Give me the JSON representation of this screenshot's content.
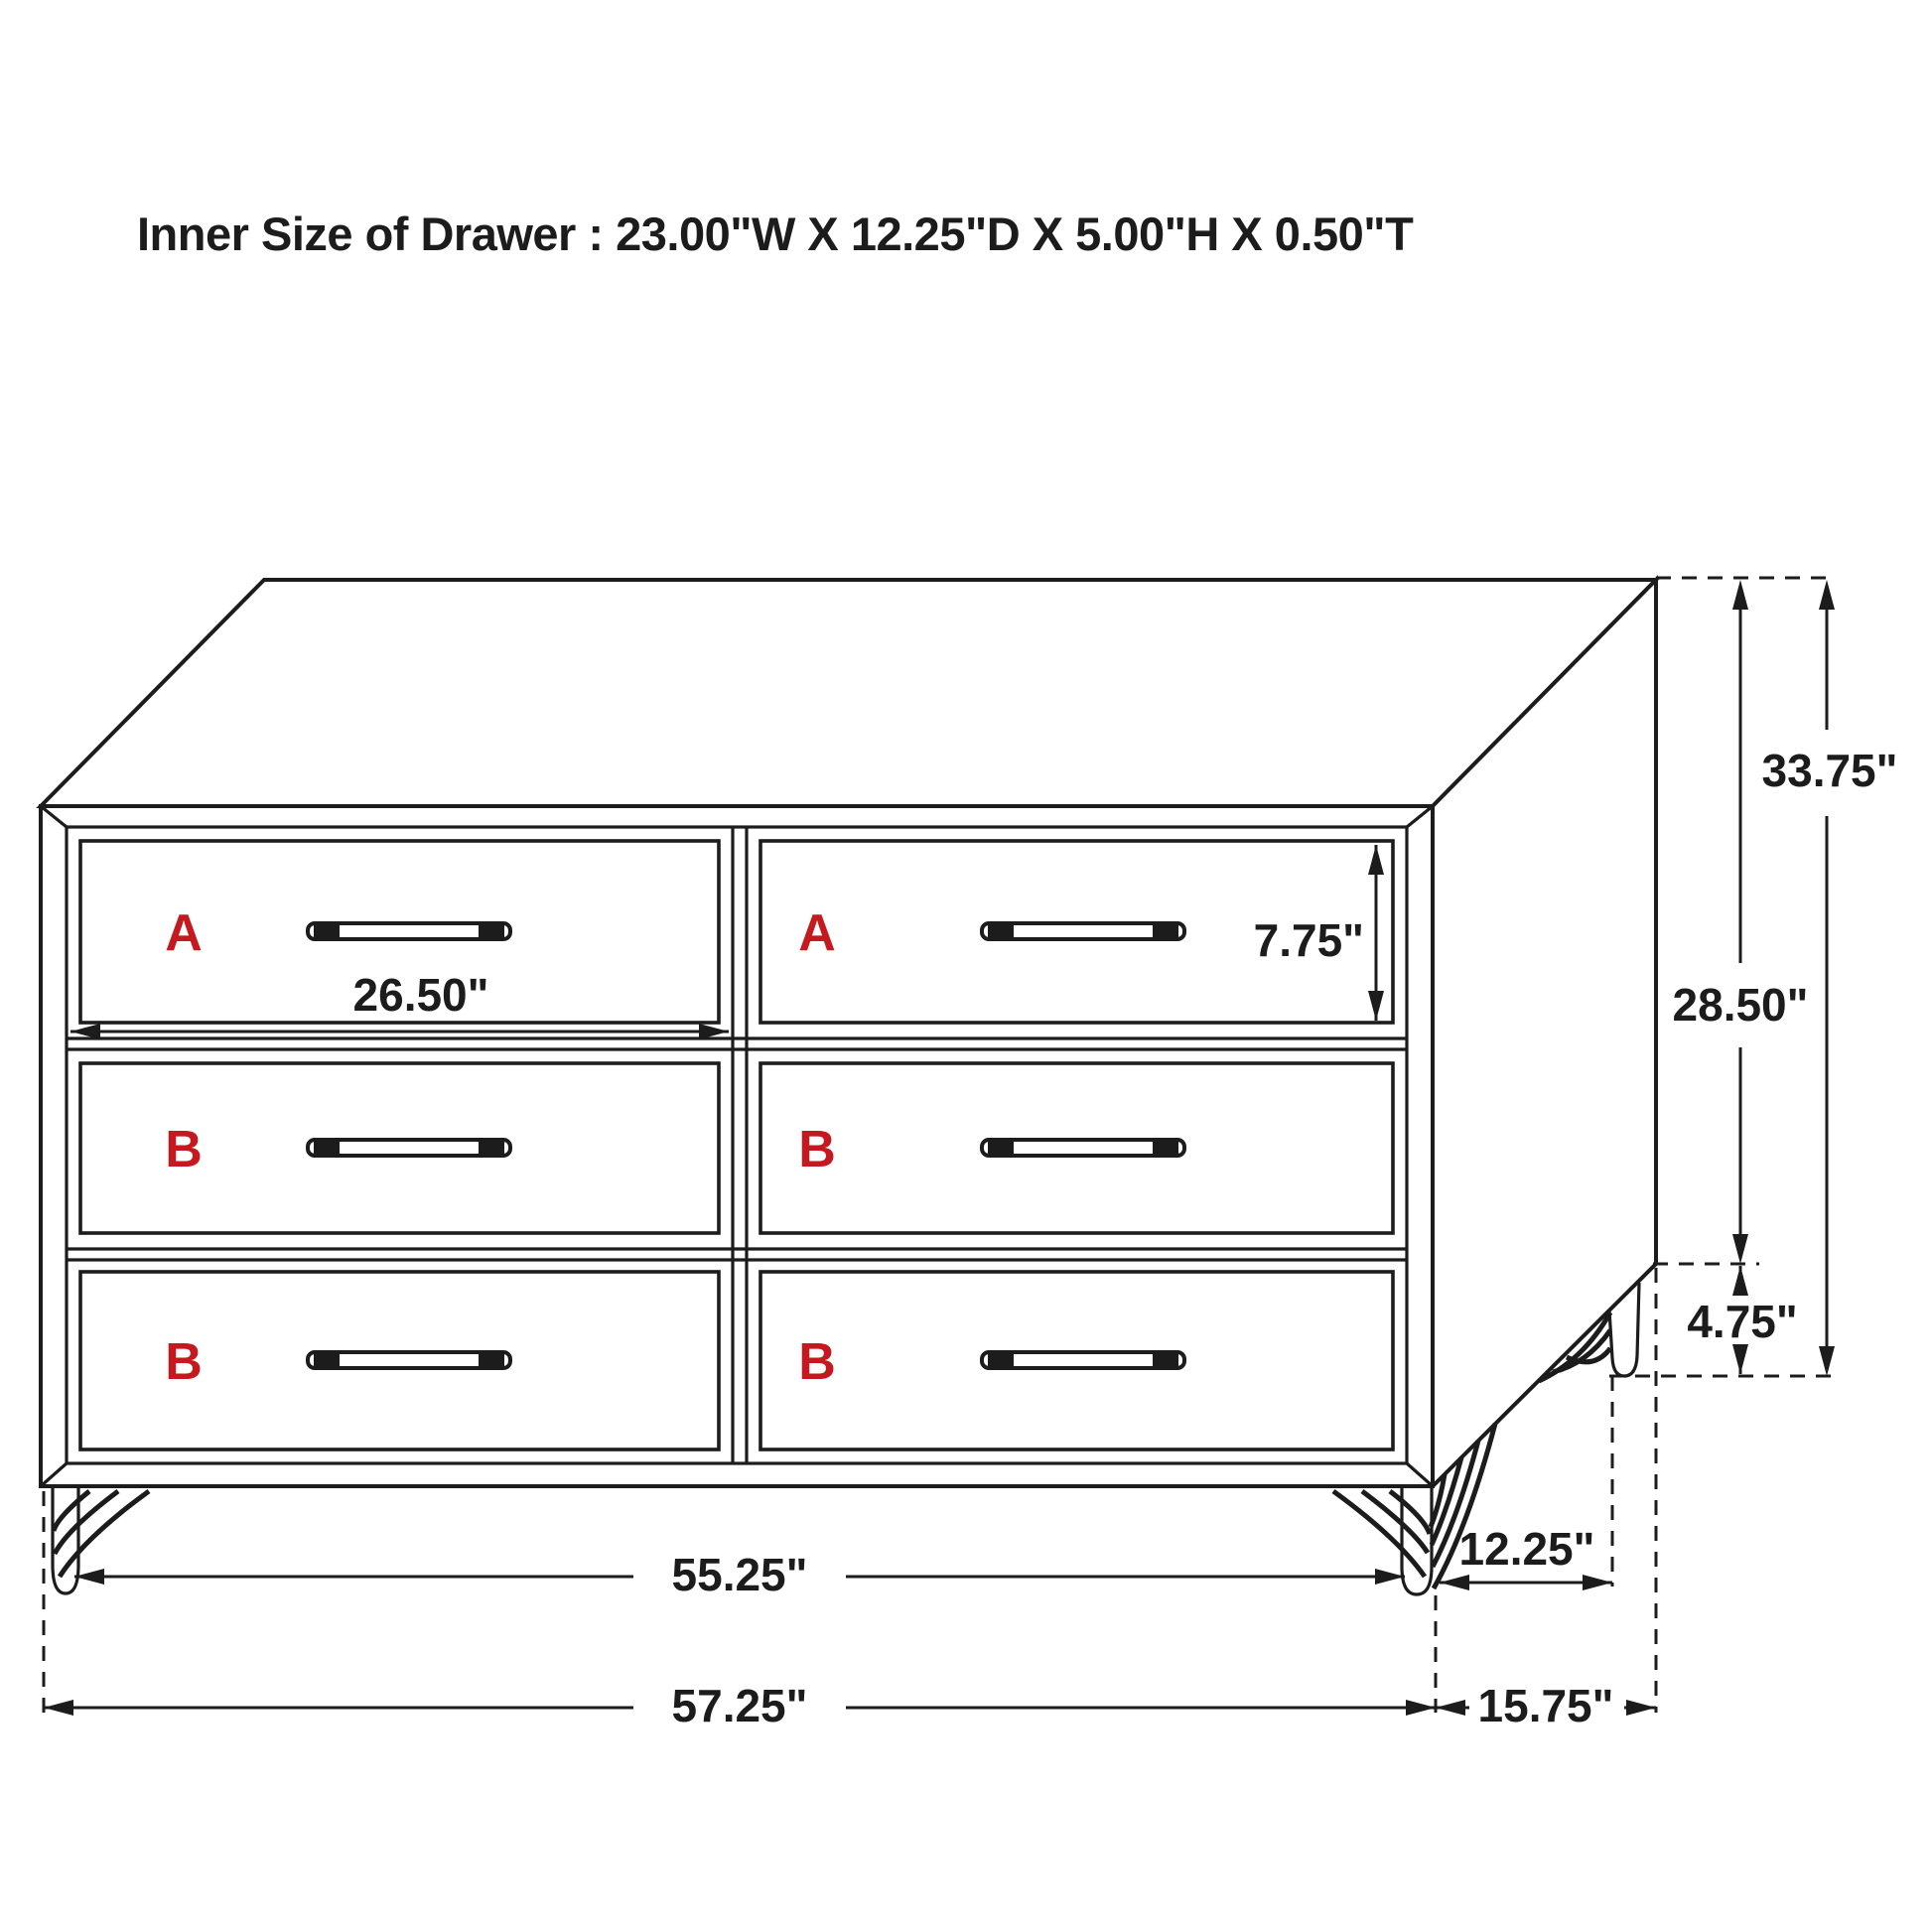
{
  "title": "Inner Size of Drawer : 23.00\"W X 12.25\"D X 5.00\"H X 0.50\"T",
  "colors": {
    "line": "#1c1c1c",
    "label_red": "#c41a1f",
    "background": "#ffffff"
  },
  "drawer_labels": {
    "top_left": "A",
    "top_right": "A",
    "middle_left": "B",
    "middle_right": "B",
    "bottom_left": "B",
    "bottom_right": "B"
  },
  "dimensions": {
    "drawer_opening_width": "26.50\"",
    "drawer_front_height": "7.75\"",
    "total_height": "33.75\"",
    "body_height": "28.50\"",
    "leg_height": "4.75\"",
    "front_leg_span": "55.25\"",
    "side_leg_span": "12.25\"",
    "total_width": "57.25\"",
    "total_depth": "15.75\""
  }
}
